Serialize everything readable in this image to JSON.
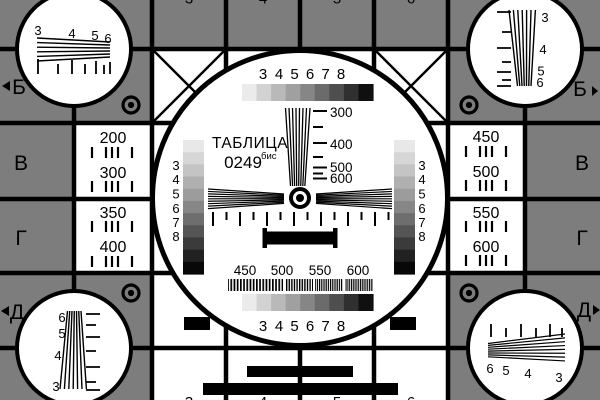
{
  "colors": {
    "bg": "#7d7d7d",
    "ink": "#000000",
    "paper": "#ffffff"
  },
  "title": {
    "line1": "ТАБЛИЦА",
    "code": "0249",
    "suffix": "бис"
  },
  "row_labels": {
    "left": [
      "Б",
      "В",
      "Г",
      "Д"
    ],
    "right": [
      "Б",
      "В",
      "Г",
      "Д"
    ]
  },
  "icons": {
    "row_arrow_left": "left-triangle",
    "row_arrow_right": "right-triangle",
    "target": "concentric-circles",
    "center_mark": "bullseye"
  },
  "column_digits": {
    "top": [
      "3",
      "4",
      "5",
      "6"
    ],
    "bottom": [
      "3",
      "4",
      "5",
      "6"
    ]
  },
  "step_digits": [
    "3",
    "4",
    "5",
    "6",
    "7",
    "8"
  ],
  "freq_vertical_labels": [
    "300",
    "400",
    "500",
    "600"
  ],
  "freq_horizontal_labels": [
    "450",
    "500",
    "550",
    "600"
  ],
  "left_cell_numbers": [
    "200",
    "300",
    "350",
    "400"
  ],
  "right_cell_numbers": [
    "450",
    "500",
    "550",
    "600"
  ],
  "corner_wedge_digits": {
    "top_left": [
      "3",
      "4",
      "5",
      "6"
    ],
    "top_right": [
      "3",
      "4",
      "5",
      "6"
    ],
    "bottom_left": [
      "6",
      "5",
      "4",
      "3"
    ],
    "bottom_right": [
      "6",
      "5",
      "4",
      "3"
    ]
  },
  "gray": {
    "h_strip": [
      "#ebebeb",
      "#d2d2d2",
      "#b9b9b9",
      "#a0a0a0",
      "#868686",
      "#6b6b6b",
      "#4f4f4f",
      "#303030",
      "#101010"
    ],
    "v_strip": [
      "#e8e8e8",
      "#d6d6d6",
      "#c4c4c4",
      "#b0b0b0",
      "#9c9c9c",
      "#868686",
      "#6e6e6e",
      "#555555",
      "#3b3b3b",
      "#212121",
      "#080808"
    ]
  }
}
